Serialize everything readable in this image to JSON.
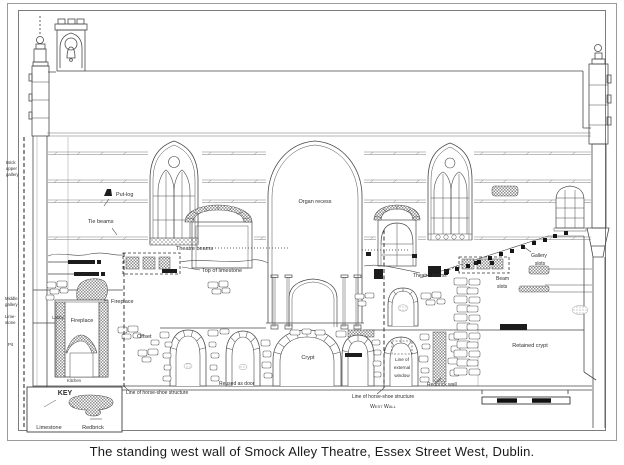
{
  "caption": "The standing west wall of Smock Alley Theatre, Essex Street West, Dublin.",
  "key": {
    "title": "KEY",
    "limestone": "Limestone",
    "redbrick": "Redbrick"
  },
  "margin": {
    "brick": "Brick",
    "upper": "upper",
    "gallery": "gallery",
    "middle": "Middle",
    "middle_gallery": "gallery",
    "lime": "Lime-",
    "stone": "stone",
    "pit": "Pit"
  },
  "labels": {
    "put_log": "Put-log",
    "tie_beams": "Tie beams",
    "organ_recess": "Organ recess",
    "theatre_beams_left": "Theatre beams",
    "top_of_limestone": "Top of limestone",
    "fireplace_upper": "Fireplace",
    "lobby": "Lobby",
    "fireplace_lower": "Fireplace",
    "kitchen": "Kitchen",
    "offset": "Offset",
    "line_horse_shoe_left": "Line of horse-shoe structure",
    "reused_as_door": "Reused as door",
    "crypt": "Crypt",
    "line_external_1": "Line of",
    "line_external_2": "external",
    "line_external_3": "window",
    "redbrick_wall": "Redbrick wall",
    "line_horse_shoe_right": "Line of horse-shoe structure",
    "west_wall": "West Wall",
    "retained_crypt": "Retained crypt",
    "theatre_beams_right": "Theatre beams",
    "beam_1": "Beam",
    "beam_2": "slots",
    "gal_1": "Gallery",
    "gal_2": "slots"
  },
  "colors": {
    "ink": "#3c3c3c",
    "line": "#6e6e6e",
    "paper": "#ffffff",
    "brick": "#8f8f8f"
  }
}
